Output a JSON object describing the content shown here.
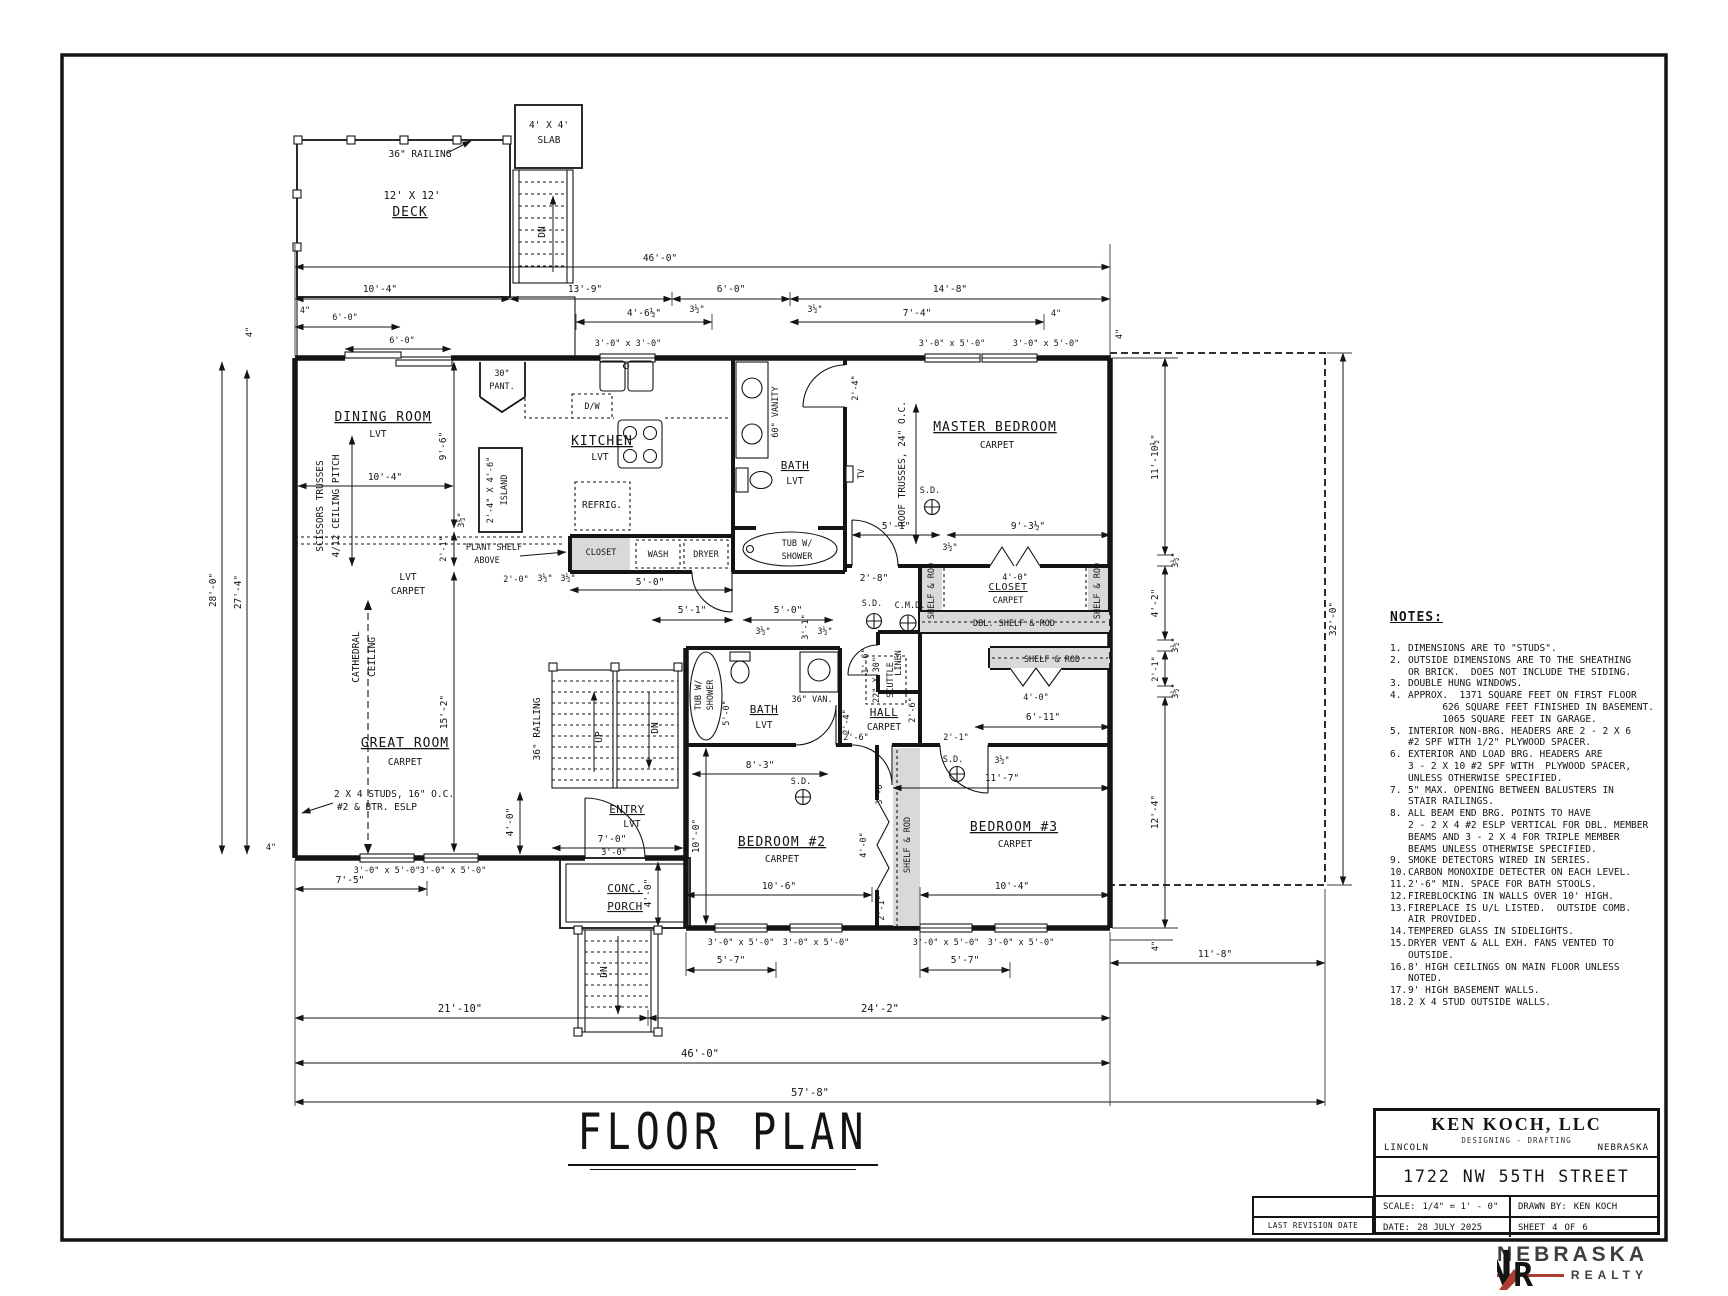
{
  "title": "FLOOR PLAN",
  "colors": {
    "ink": "#141414",
    "shade": "#d9d9d9",
    "accent_red": "#ab3c31",
    "logo_gray": "#3f3d3f"
  },
  "dims": {
    "d4": "4\"",
    "d3h": "3½\"",
    "d16": "1'-6\"",
    "d20": "2'-0\"",
    "d21": "2'-1\"",
    "d24": "2'-4\"",
    "d26": "2'-6\"",
    "d28": "2'-8\"",
    "d30": "3'-0\"",
    "d31": "3'-1\"",
    "d40": "4'-0\"",
    "d42": "4'-2\"",
    "d46h": "4'-6½\"",
    "d50": "5'-0\"",
    "d51": "5'-1\"",
    "d57": "5'-7\"",
    "d60": "6'-0\"",
    "d611": "6'-11\"",
    "d70": "7'-0\"",
    "d74": "7'-4\"",
    "d75": "7'-5\"",
    "d83": "8'-3\"",
    "d93h": "9'-3½\"",
    "d96": "9'-6\"",
    "d100": "10'-0\"",
    "d104": "10'-4\"",
    "d106": "10'-6\"",
    "d117": "11'-7\"",
    "d118": "11'-8\"",
    "d1110h": "11'-10½\"",
    "d124": "12'-4\"",
    "d139": "13'-9\"",
    "d148": "14'-8\"",
    "d152": "15'-2\"",
    "d2110": "21'-10\"",
    "d242": "24'-2\"",
    "d274": "27'-4\"",
    "d280": "28'-0\"",
    "d320": "32'-0\"",
    "d460": "46'-0\"",
    "d578": "57'-8\"",
    "w3030": "3'-0\" x 3'-0\"",
    "w3050": "3'-0\" x 5'-0\""
  },
  "rooms": {
    "dining": "DINING ROOM",
    "kitchen": "KITCHEN",
    "great": "GREAT ROOM",
    "master": "MASTER BEDROOM",
    "bath": "BATH",
    "hall": "HALL",
    "closet": "CLOSET",
    "entry": "ENTRY",
    "porch1": "CONC.",
    "porch2": "PORCH",
    "bed2": "BEDROOM #2",
    "bed3": "BEDROOM #3",
    "deck1": "12' X 12'",
    "deck2": "DECK",
    "slab1": "4' X 4'",
    "slab2": "SLAB",
    "lvt": "LVT",
    "carpet": "CARPET"
  },
  "fix": {
    "pant1": "30\"",
    "pant2": "PANT.",
    "dw": "D/W",
    "island1": "2'-4\" X 4'-6\"",
    "island2": "ISLAND",
    "refrig": "REFRIG.",
    "wash": "WASH",
    "dryer": "DRYER",
    "plant1": "PLANT SHELF",
    "plant2": "ABOVE",
    "van60": "60\" VANITY",
    "van36": "36\" VAN.",
    "tub1": "TUB W/",
    "tub2": "SHOWER",
    "linen": "LINEN",
    "sr": "SHELF & ROD",
    "dsr": "DBL. SHELF & ROD",
    "scut1": "22\" X 30\"",
    "scut2": "SCUTTLE",
    "sd": "S.D.",
    "cmd": "C.M.D.",
    "tv": "TV",
    "rail36": "36\" RAILING",
    "dn": "DN",
    "up": "UP",
    "cath1": "CATHEDRAL",
    "cath2": "CEILING",
    "scis1": "SCISSORS TRUSSES",
    "scis2": "4/12 CEILING PITCH",
    "rt": "ROOF TRUSSES, 24\" O.C.",
    "studs1": "2 X 4 STUDS, 16\" O.C.",
    "studs2": "#2 & BTR. ESLP"
  },
  "notes": {
    "heading": "NOTES:",
    "items": [
      {
        "n": "1.",
        "t": "DIMENSIONS ARE TO \"STUDS\"."
      },
      {
        "n": "2.",
        "t": "OUTSIDE DIMENSIONS ARE TO THE SHEATHING\nOR BRICK.  DOES NOT INCLUDE THE SIDING."
      },
      {
        "n": "3.",
        "t": "DOUBLE HUNG WINDOWS."
      },
      {
        "n": "4.",
        "t": "APPROX.  1371 SQUARE FEET ON FIRST FLOOR\n      626 SQUARE FEET FINISHED IN BASEMENT.\n      1065 SQUARE FEET IN GARAGE."
      },
      {
        "n": "5.",
        "t": "INTERIOR NON-BRG. HEADERS ARE 2 - 2 X 6\n#2 SPF WITH 1/2\" PLYWOOD SPACER."
      },
      {
        "n": "6.",
        "t": "EXTERIOR AND LOAD BRG. HEADERS ARE\n3 - 2 X 10 #2 SPF WITH  PLYWOOD SPACER,\nUNLESS OTHERWISE SPECIFIED."
      },
      {
        "n": "7.",
        "t": "5\" MAX. OPENING BETWEEN BALUSTERS IN\nSTAIR RAILINGS."
      },
      {
        "n": "8.",
        "t": "ALL BEAM END BRG. POINTS TO HAVE\n2 - 2 X 4 #2 ESLP VERTICAL FOR DBL. MEMBER\nBEAMS AND 3 - 2 X 4 FOR TRIPLE MEMBER\nBEAMS UNLESS OTHERWISE SPECIFIED."
      },
      {
        "n": "9.",
        "t": "SMOKE DETECTORS WIRED IN SERIES."
      },
      {
        "n": "10.",
        "t": "CARBON MONOXIDE DETECTER ON EACH LEVEL."
      },
      {
        "n": "11.",
        "t": "2'-6\" MIN. SPACE FOR BATH STOOLS."
      },
      {
        "n": "12.",
        "t": "FIREBLOCKING IN WALLS OVER 10' HIGH."
      },
      {
        "n": "13.",
        "t": "FIREPLACE IS U/L LISTED.  OUTSIDE COMB.\nAIR PROVIDED."
      },
      {
        "n": "14.",
        "t": "TEMPERED GLASS IN SIDELIGHTS."
      },
      {
        "n": "15.",
        "t": "DRYER VENT & ALL EXH. FANS VENTED TO OUTSIDE."
      },
      {
        "n": "16.",
        "t": "8' HIGH CEILINGS ON MAIN FLOOR UNLESS NOTED."
      },
      {
        "n": "17.",
        "t": "9' HIGH BASEMENT WALLS."
      },
      {
        "n": "18.",
        "t": "2 X 4 STUD OUTSIDE WALLS."
      }
    ]
  },
  "tb": {
    "company": "KEN KOCH, LLC",
    "tagline": "DESIGNING - DRAFTING",
    "city": "LINCOLN",
    "state": "NEBRASKA",
    "address": "1722 NW 55TH STREET",
    "scale_label": "SCALE:",
    "scale_value": "1/4\" = 1' - 0\"",
    "drawn_label": "DRAWN BY:",
    "drawn_value": "KEN KOCH",
    "date_label": "DATE:",
    "date_value": "28 JULY 2025",
    "sheet_label": "SHEET",
    "sheet_num": "4",
    "of_label": "OF",
    "sheet_total": "6",
    "last_revision": "LAST REVISION DATE"
  },
  "logo": {
    "n": "N",
    "r": "R",
    "name1": "NEBRASKA",
    "name2": "REALTY"
  }
}
